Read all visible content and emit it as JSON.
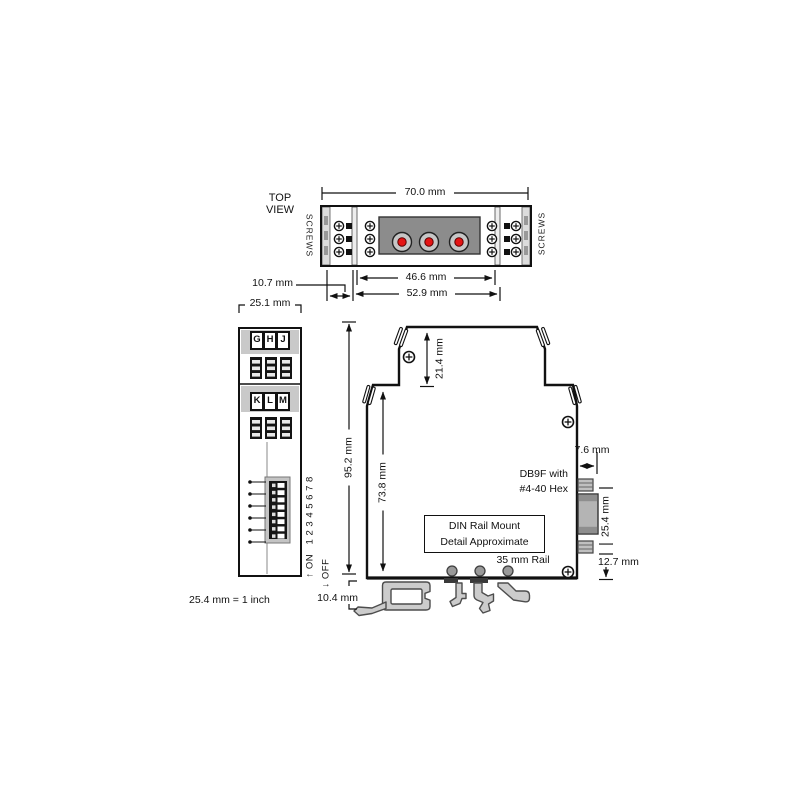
{
  "colors": {
    "line": "#111111",
    "panel_gray": "#8c8c8c",
    "band_gray": "#c9c9c9",
    "clip_gray": "#cccccc",
    "connector_red": "#e41414",
    "ring_gray": "#c6c6c6"
  },
  "top_view": {
    "title_line1": "TOP",
    "title_line2": "VIEW",
    "screws_left": "SCREWS",
    "screws_right": "SCREWS",
    "dim_width": "70.0 mm",
    "dim_connector": "46.6 mm",
    "dim_mount": "52.9 mm",
    "dim_offset": "10.7 mm"
  },
  "left_view": {
    "dim_width": "25.1 mm",
    "terminal_letters_top": [
      "G",
      "H",
      "J"
    ],
    "terminal_letters_mid": [
      "K",
      "L",
      "M"
    ],
    "dip_on_label": "↑ ON   1 2 3 4 5 6 7 8",
    "dip_off_label": "↓ OFF"
  },
  "side_view": {
    "dim_height": "95.2 mm",
    "dim_body_height": "73.8 mm",
    "dim_top_section": "21.4 mm",
    "dim_db9_depth": "7.6 mm",
    "dim_db9_height": "25.4 mm",
    "dim_db9_offset": "12.7 mm",
    "dim_rail_depth": "10.4 mm",
    "db9_label_line1": "DB9F with",
    "db9_label_line2": "#4-40 Hex",
    "din_note_line1": "DIN Rail Mount",
    "din_note_line2": "Detail Approximate",
    "rail_label": "35 mm Rail"
  },
  "notes": {
    "scale": "25.4 mm = 1 inch"
  }
}
